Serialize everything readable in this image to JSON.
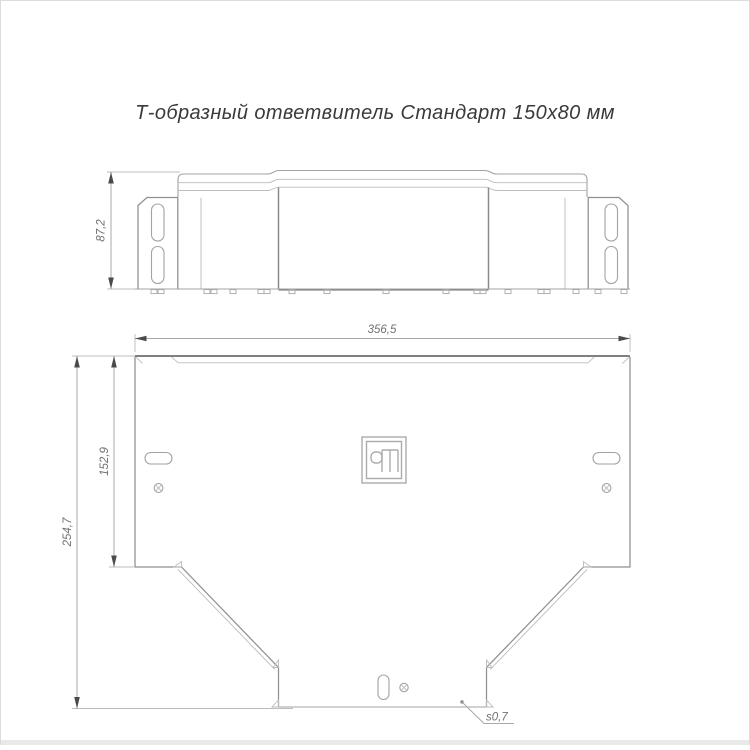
{
  "title": "Т-образный ответвитель Стандарт 150х80 мм",
  "side_view": {
    "height_dim": "87,2"
  },
  "plan_view": {
    "width_dim": "356,5",
    "branch_height_dim": "152,9",
    "total_height_dim": "254,7",
    "thickness_label": "s0,7"
  },
  "icons": {
    "logo": "manufacturer-logo-icon",
    "screw_hole": "screw-hole-icon"
  },
  "colors": {
    "background": "#ffffff",
    "page_border": "#dcdcdc",
    "bottom_strip": "#e9e9e9",
    "line_light": "#bcbcbc",
    "line_mid": "#a3a3a3",
    "line_dark": "#7f7f7f",
    "dim_arrow": "#4a4a4a",
    "dim_text": "#707070",
    "title_text": "#3a3a3a"
  }
}
